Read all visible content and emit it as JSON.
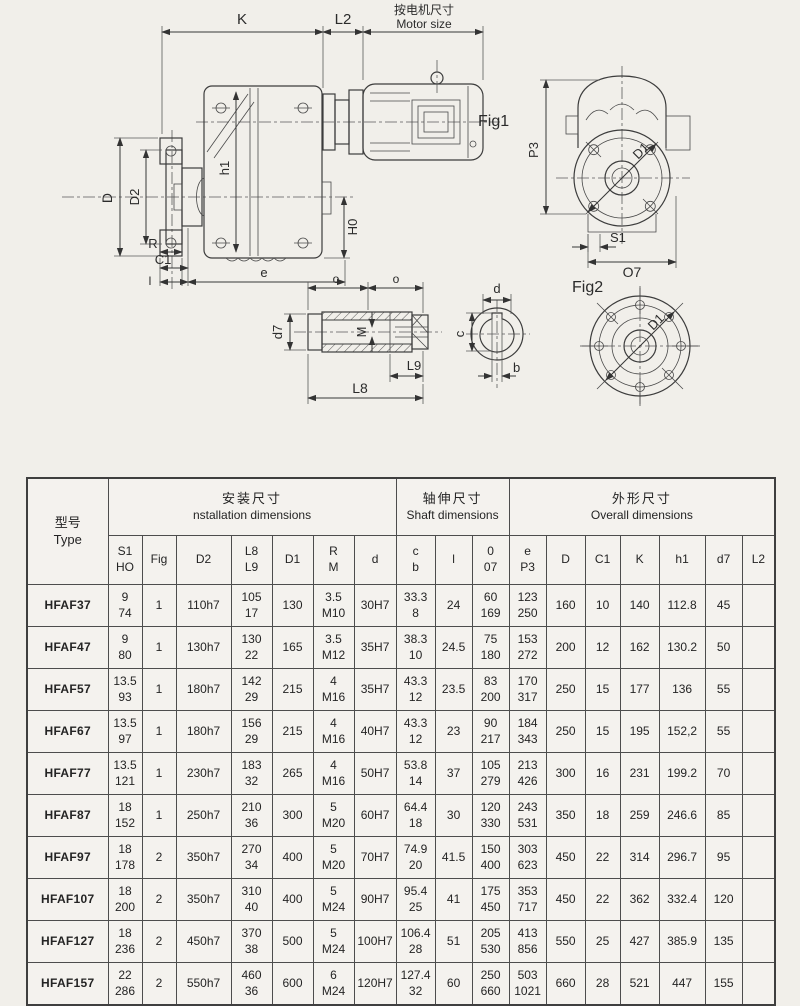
{
  "drawing": {
    "labels": {
      "k": "K",
      "l2": "L2",
      "motor_size_zh": "按电机尺寸",
      "motor_size_en": "Motor size",
      "d": "D",
      "d2": "D2",
      "h1": "h1",
      "h0": "H0",
      "r": "R",
      "c1": "C1",
      "l_bottom": "l",
      "e": "e",
      "fig1": "Fig1",
      "p3": "P3",
      "d1": "D1",
      "s1": "S1",
      "o7": "O7",
      "fig2": "Fig2",
      "d1_fig2": "D1",
      "o_left": "o",
      "o_right": "o",
      "d7": "d7",
      "m": "M",
      "l9": "L9",
      "l8": "L8",
      "sec_d": "d",
      "sec_c": "c",
      "sec_b": "b"
    }
  },
  "table": {
    "header": {
      "type_zh": "型号",
      "type_en": "Type",
      "groups": [
        {
          "zh": "安装尺寸",
          "en": "nstallation dimensions",
          "span": 7
        },
        {
          "zh": "轴伸尺寸",
          "en": "Shaft dimensions",
          "span": 3
        },
        {
          "zh": "外形尺寸",
          "en": "Overall dimensions",
          "span": 7
        }
      ],
      "subcols": [
        [
          "S1",
          "HO"
        ],
        [
          "Fig"
        ],
        [
          "D2"
        ],
        [
          "L8",
          "L9"
        ],
        [
          "D1"
        ],
        [
          "R",
          "M"
        ],
        [
          "d"
        ],
        [
          "c",
          "b"
        ],
        [
          "l"
        ],
        [
          "0",
          "07"
        ],
        [
          "e",
          "P3"
        ],
        [
          "D"
        ],
        [
          "C1"
        ],
        [
          "K"
        ],
        [
          "h1"
        ],
        [
          "d7"
        ],
        [
          "L2"
        ]
      ]
    },
    "rows": [
      {
        "type": "HFAF37",
        "cells": [
          [
            "9",
            "74"
          ],
          [
            "1"
          ],
          [
            "110h7"
          ],
          [
            "105",
            "17"
          ],
          [
            "130"
          ],
          [
            "3.5",
            "M10"
          ],
          [
            "30H7"
          ],
          [
            "33.3",
            "8"
          ],
          [
            "24"
          ],
          [
            "60",
            "169"
          ],
          [
            "123",
            "250"
          ],
          [
            "160"
          ],
          [
            "10"
          ],
          [
            "140"
          ],
          [
            "112.8"
          ],
          [
            "45"
          ],
          [
            ""
          ]
        ]
      },
      {
        "type": "HFAF47",
        "cells": [
          [
            "9",
            "80"
          ],
          [
            "1"
          ],
          [
            "130h7"
          ],
          [
            "130",
            "22"
          ],
          [
            "165"
          ],
          [
            "3.5",
            "M12"
          ],
          [
            "35H7"
          ],
          [
            "38.3",
            "10"
          ],
          [
            "24.5"
          ],
          [
            "75",
            "180"
          ],
          [
            "153",
            "272"
          ],
          [
            "200"
          ],
          [
            "12"
          ],
          [
            "162"
          ],
          [
            "130.2"
          ],
          [
            "50"
          ],
          [
            ""
          ]
        ]
      },
      {
        "type": "HFAF57",
        "cells": [
          [
            "13.5",
            "93"
          ],
          [
            "1"
          ],
          [
            "180h7"
          ],
          [
            "142",
            "29"
          ],
          [
            "215"
          ],
          [
            "4",
            "M16"
          ],
          [
            "35H7"
          ],
          [
            "43.3",
            "12"
          ],
          [
            "23.5"
          ],
          [
            "83",
            "200"
          ],
          [
            "170",
            "317"
          ],
          [
            "250"
          ],
          [
            "15"
          ],
          [
            "177"
          ],
          [
            "136"
          ],
          [
            "55"
          ],
          [
            ""
          ]
        ]
      },
      {
        "type": "HFAF67",
        "cells": [
          [
            "13.5",
            "97"
          ],
          [
            "1"
          ],
          [
            "180h7"
          ],
          [
            "156",
            "29"
          ],
          [
            "215"
          ],
          [
            "4",
            "M16"
          ],
          [
            "40H7"
          ],
          [
            "43.3",
            "12"
          ],
          [
            "23"
          ],
          [
            "90",
            "217"
          ],
          [
            "184",
            "343"
          ],
          [
            "250"
          ],
          [
            "15"
          ],
          [
            "195"
          ],
          [
            "152,2"
          ],
          [
            "55"
          ],
          [
            ""
          ]
        ]
      },
      {
        "type": "HFAF77",
        "cells": [
          [
            "13.5",
            "121"
          ],
          [
            "1"
          ],
          [
            "230h7"
          ],
          [
            "183",
            "32"
          ],
          [
            "265"
          ],
          [
            "4",
            "M16"
          ],
          [
            "50H7"
          ],
          [
            "53.8",
            "14"
          ],
          [
            "37"
          ],
          [
            "105",
            "279"
          ],
          [
            "213",
            "426"
          ],
          [
            "300"
          ],
          [
            "16"
          ],
          [
            "231"
          ],
          [
            "199.2"
          ],
          [
            "70"
          ],
          [
            ""
          ]
        ]
      },
      {
        "type": "HFAF87",
        "cells": [
          [
            "18",
            "152"
          ],
          [
            "1"
          ],
          [
            "250h7"
          ],
          [
            "210",
            "36"
          ],
          [
            "300"
          ],
          [
            "5",
            "M20"
          ],
          [
            "60H7"
          ],
          [
            "64.4",
            "18"
          ],
          [
            "30"
          ],
          [
            "120",
            "330"
          ],
          [
            "243",
            "531"
          ],
          [
            "350"
          ],
          [
            "18"
          ],
          [
            "259"
          ],
          [
            "246.6"
          ],
          [
            "85"
          ],
          [
            ""
          ]
        ]
      },
      {
        "type": "HFAF97",
        "cells": [
          [
            "18",
            "178"
          ],
          [
            "2"
          ],
          [
            "350h7"
          ],
          [
            "270",
            "34"
          ],
          [
            "400"
          ],
          [
            "5",
            "M20"
          ],
          [
            "70H7"
          ],
          [
            "74.9",
            "20"
          ],
          [
            "41.5"
          ],
          [
            "150",
            "400"
          ],
          [
            "303",
            "623"
          ],
          [
            "450"
          ],
          [
            "22"
          ],
          [
            "314"
          ],
          [
            "296.7"
          ],
          [
            "95"
          ],
          [
            ""
          ]
        ]
      },
      {
        "type": "HFAF107",
        "cells": [
          [
            "18",
            "200"
          ],
          [
            "2"
          ],
          [
            "350h7"
          ],
          [
            "310",
            "40"
          ],
          [
            "400"
          ],
          [
            "5",
            "M24"
          ],
          [
            "90H7"
          ],
          [
            "95.4",
            "25"
          ],
          [
            "41"
          ],
          [
            "175",
            "450"
          ],
          [
            "353",
            "717"
          ],
          [
            "450"
          ],
          [
            "22"
          ],
          [
            "362"
          ],
          [
            "332.4"
          ],
          [
            "120"
          ],
          [
            ""
          ]
        ]
      },
      {
        "type": "HFAF127",
        "cells": [
          [
            "18",
            "236"
          ],
          [
            "2"
          ],
          [
            "450h7"
          ],
          [
            "370",
            "38"
          ],
          [
            "500"
          ],
          [
            "5",
            "M24"
          ],
          [
            "100H7"
          ],
          [
            "106.4",
            "28"
          ],
          [
            "51"
          ],
          [
            "205",
            "530"
          ],
          [
            "413",
            "856"
          ],
          [
            "550"
          ],
          [
            "25"
          ],
          [
            "427"
          ],
          [
            "385.9"
          ],
          [
            "135"
          ],
          [
            ""
          ]
        ]
      },
      {
        "type": "HFAF157",
        "cells": [
          [
            "22",
            "286"
          ],
          [
            "2"
          ],
          [
            "550h7"
          ],
          [
            "460",
            "36"
          ],
          [
            "600"
          ],
          [
            "6",
            "M24"
          ],
          [
            "120H7"
          ],
          [
            "127.4",
            "32"
          ],
          [
            "60"
          ],
          [
            "250",
            "660"
          ],
          [
            "503",
            "1021"
          ],
          [
            "660"
          ],
          [
            "28"
          ],
          [
            "521"
          ],
          [
            "447"
          ],
          [
            "155"
          ],
          [
            ""
          ]
        ]
      }
    ]
  }
}
